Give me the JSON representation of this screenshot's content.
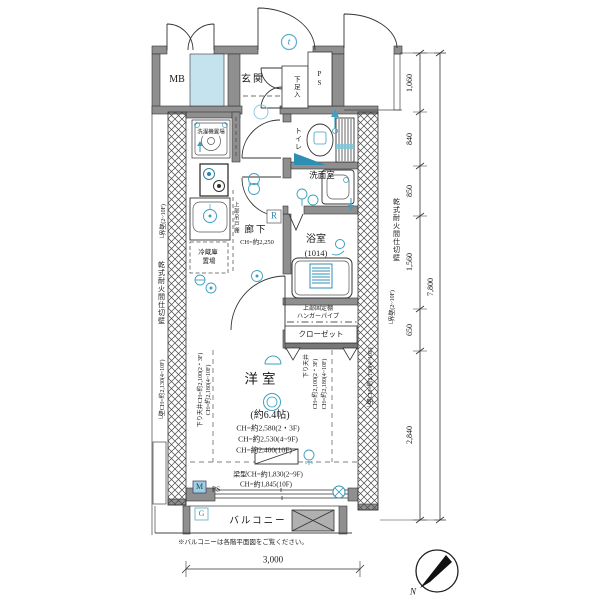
{
  "rooms": {
    "mb": "MB",
    "genkan": "玄関",
    "shoe_box": "下足入",
    "ps_top": "PS",
    "toilet": "トイレ",
    "washroom": "洗面室",
    "corridor": "廊下",
    "corridor_ch": "CH=約2,250",
    "bath": "浴室",
    "bath_size": "(1014)",
    "closet": "クローゼット",
    "western": "洋室",
    "western_size": "(約6.4帖)",
    "balcony": "バルコニー",
    "ps_bottom": "PS"
  },
  "fixtures": {
    "laundry": "洗濯機置場",
    "fridge_1": "冷蔵庫",
    "fridge_2": "置場",
    "upper_cabinet": "上部吊戸棚",
    "upper_shelf": "上部固定棚",
    "hanger_pipe": "ハンガーパイプ"
  },
  "ceiling": {
    "ch_23f": "CH=約2,580(2・3F)",
    "ch_49f": "CH=約2,530(4~9F)",
    "ch_10f": "CH=約2,400(10F)",
    "down_left": "下り天井CH=約2,100(2・3F)",
    "down_left2": "CH=約2,180(4~10F)",
    "down_right": "下り天井",
    "down_right1": "CH=約2,100(2・3F)",
    "down_right2": "CH=約2,180(4~10F)",
    "beam1": "梁型CH=約1,830(2~9F)",
    "beam2": "CH=約1,845(10F)"
  },
  "walls": {
    "dry_partition": "乾式耐火間仕切壁",
    "boundary": "└界壁(2~10F)",
    "wall_ch": "└壁CH=約2,130(4~10F)"
  },
  "dims": {
    "right": [
      "1,060",
      "840",
      "850",
      "1,560",
      "650",
      "2,840"
    ],
    "right_total": "7,800",
    "bottom": "3,000"
  },
  "symbols": {
    "r": "R",
    "m": "M",
    "g": "G",
    "t": "t",
    "north": "N"
  },
  "note": "※バルコニーは各階平面図をご覧ください。",
  "colors": {
    "accent_blue": "#3f9fc0",
    "light_blue_fill": "#c5e3ee",
    "wall_gray": "#8f8f8f"
  }
}
